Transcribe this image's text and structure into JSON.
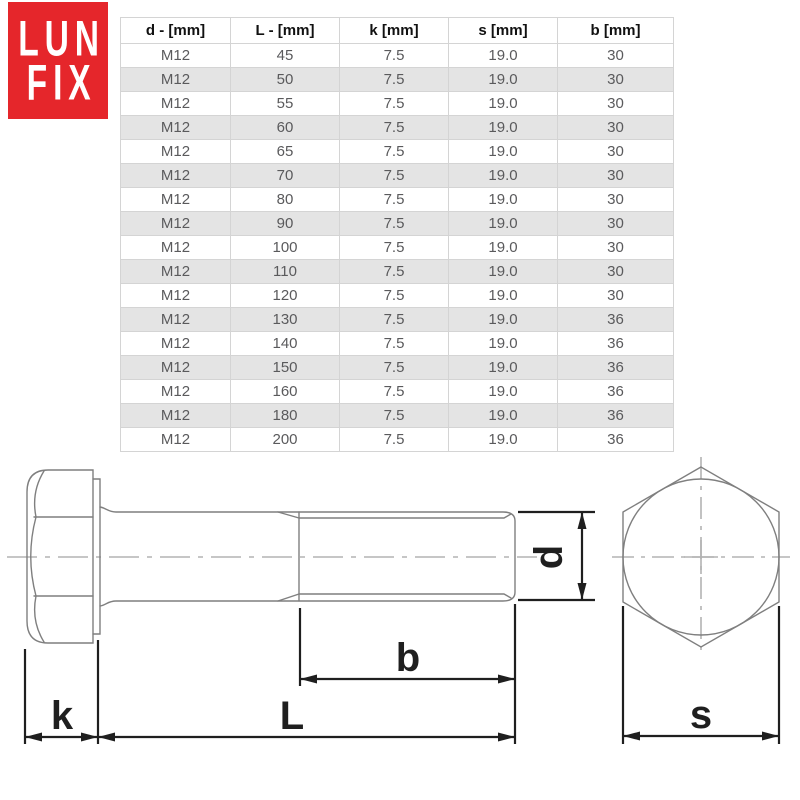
{
  "logo": {
    "line1": "LUN",
    "line2": "FIX",
    "bg_color": "#e5262b",
    "text_color": "#ffffff"
  },
  "table": {
    "headers": [
      "d - [mm]",
      "L - [mm]",
      "k [mm]",
      "s [mm]",
      "b [mm]"
    ],
    "rows": [
      [
        "M12",
        "45",
        "7.5",
        "19.0",
        "30"
      ],
      [
        "M12",
        "50",
        "7.5",
        "19.0",
        "30"
      ],
      [
        "M12",
        "55",
        "7.5",
        "19.0",
        "30"
      ],
      [
        "M12",
        "60",
        "7.5",
        "19.0",
        "30"
      ],
      [
        "M12",
        "65",
        "7.5",
        "19.0",
        "30"
      ],
      [
        "M12",
        "70",
        "7.5",
        "19.0",
        "30"
      ],
      [
        "M12",
        "80",
        "7.5",
        "19.0",
        "30"
      ],
      [
        "M12",
        "90",
        "7.5",
        "19.0",
        "30"
      ],
      [
        "M12",
        "100",
        "7.5",
        "19.0",
        "30"
      ],
      [
        "M12",
        "110",
        "7.5",
        "19.0",
        "30"
      ],
      [
        "M12",
        "120",
        "7.5",
        "19.0",
        "30"
      ],
      [
        "M12",
        "130",
        "7.5",
        "19.0",
        "36"
      ],
      [
        "M12",
        "140",
        "7.5",
        "19.0",
        "36"
      ],
      [
        "M12",
        "150",
        "7.5",
        "19.0",
        "36"
      ],
      [
        "M12",
        "160",
        "7.5",
        "19.0",
        "36"
      ],
      [
        "M12",
        "180",
        "7.5",
        "19.0",
        "36"
      ],
      [
        "M12",
        "200",
        "7.5",
        "19.0",
        "36"
      ]
    ],
    "alt_row_color": "#e4e4e4",
    "border_color": "#d4d4d4",
    "header_text_color": "#111111",
    "cell_text_color": "#5a5a5c"
  },
  "diagram": {
    "dimension_labels": {
      "head_height": "k",
      "total_length": "L",
      "thread_length": "b",
      "diameter": "d",
      "width_across_flats": "s"
    },
    "outline_color": "#7f7f7f",
    "dimension_color": "#1f1f1f",
    "centerline_color": "#b3b3b3"
  }
}
